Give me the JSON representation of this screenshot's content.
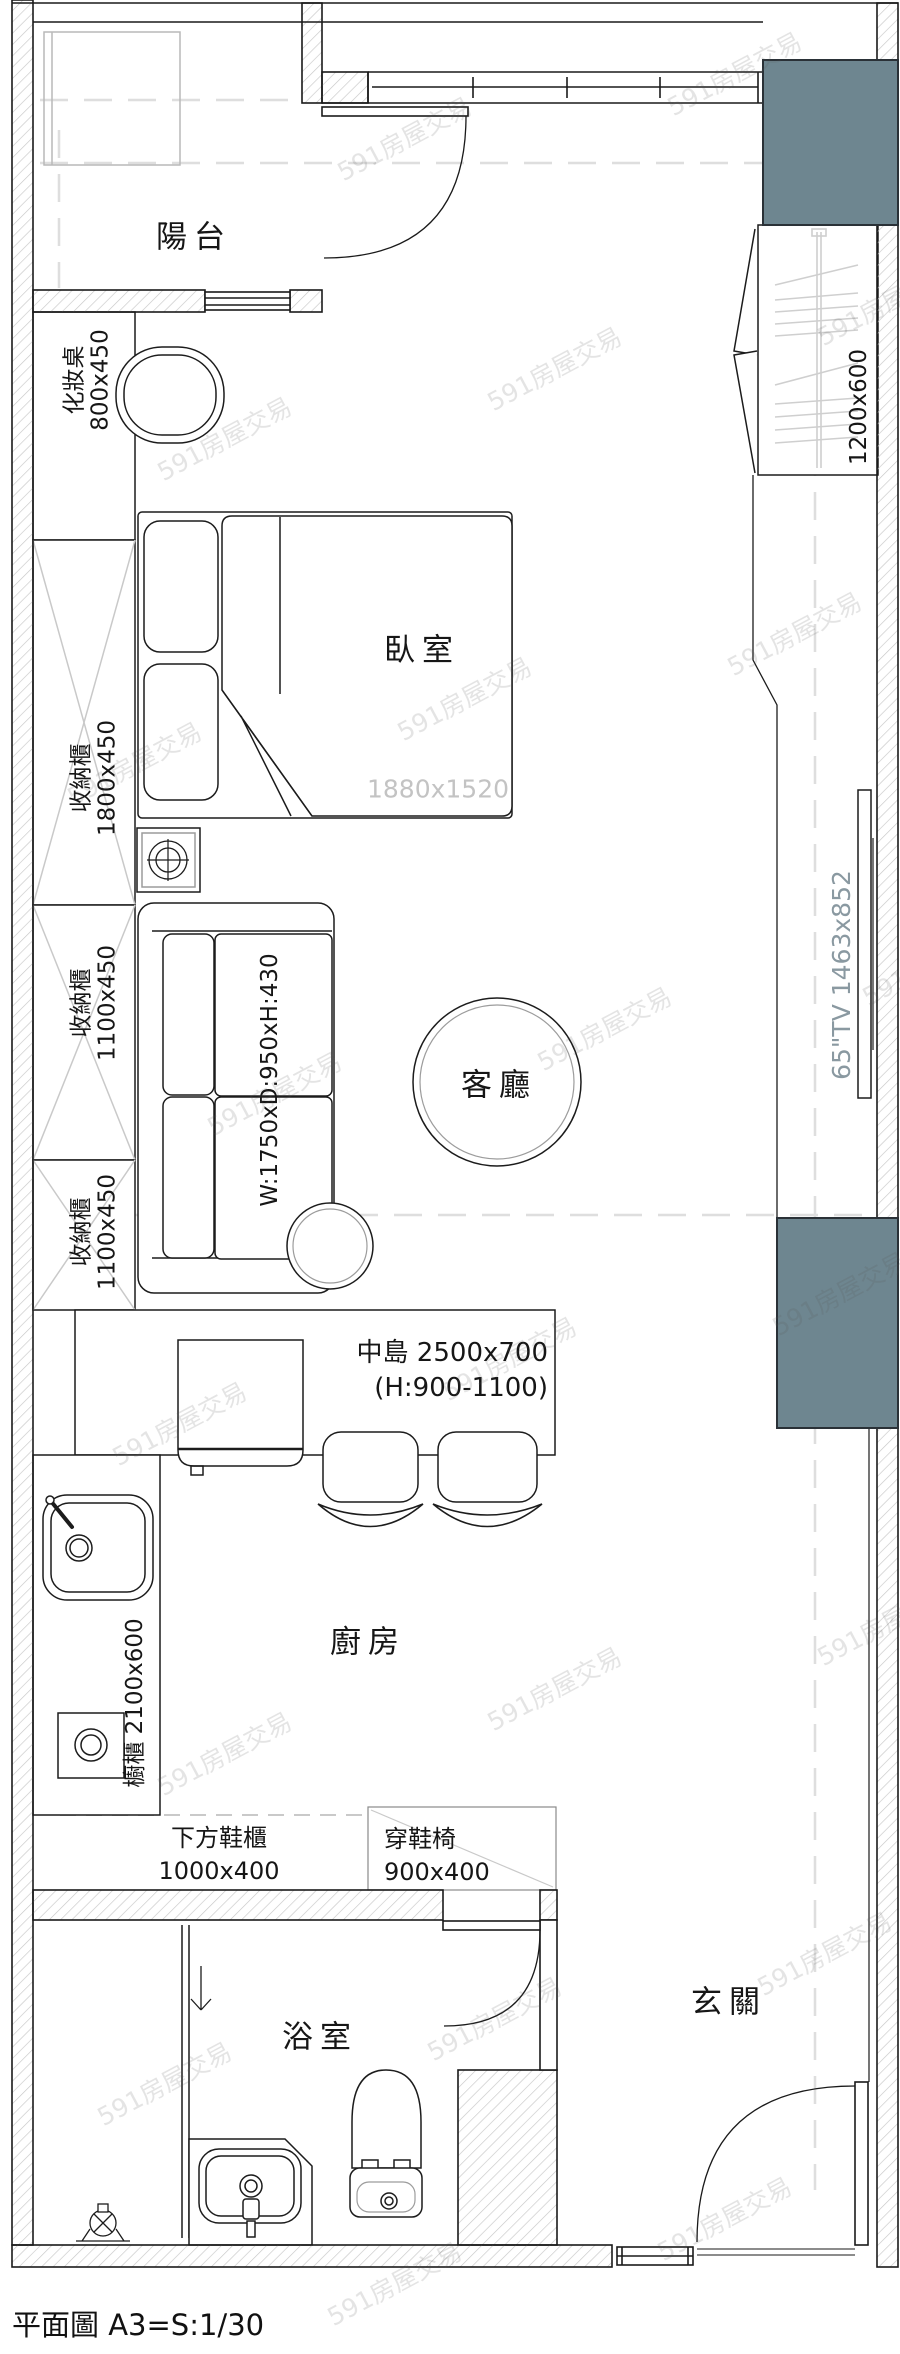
{
  "title": "平面圖 A3=S:1/30",
  "watermark": "591房屋交易",
  "colors": {
    "block": "#6e8690",
    "dim_text": "#c3c3c3",
    "tv_text": "#8a99a1"
  },
  "rooms": {
    "balcony": "陽台",
    "bedroom": "臥室",
    "living": "客廳",
    "kitchen": "廚房",
    "bathroom": "浴室",
    "entry": "玄關"
  },
  "labels": {
    "vanity": {
      "name": "化妝桌",
      "dim": "800x450"
    },
    "cabinet_a": {
      "name": "收納櫃",
      "dim": "1800x450"
    },
    "cabinet_b": {
      "name": "收納櫃",
      "dim": "1100x450"
    },
    "cabinet_c": {
      "name": "收納櫃",
      "dim": "1100x450"
    },
    "kitchen_cabinet": "櫥櫃 2100x600",
    "island_line1": "中島 2500x700",
    "island_line2": "(H:900-1100)",
    "shoe_cabinet": {
      "name": "下方鞋櫃",
      "dim": "1000x400"
    },
    "shoe_bench": {
      "name": "穿鞋椅",
      "dim": "900x400"
    },
    "bed_dim": "1880x1520",
    "wardrobe_dim": "1200x600",
    "sofa_dim": "W:1750xD:950xH:430",
    "tv_dim": "65\"TV 1463x852"
  }
}
